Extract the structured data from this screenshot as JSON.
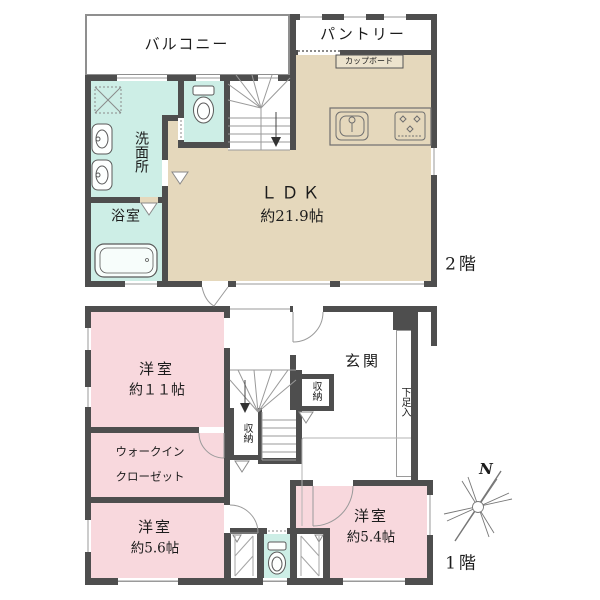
{
  "plan": {
    "floor2": {
      "label": "2階",
      "balcony": "バルコニー",
      "pantry": "パントリー",
      "cupboard": "カップボード",
      "washroom": "洗面所",
      "bath": "浴室",
      "ldk_name": "ＬＤＫ",
      "ldk_size": "約21.9帖"
    },
    "floor1": {
      "label": "1階",
      "bedroom1_name": "洋室",
      "bedroom1_size": "約１１帖",
      "wic_line1": "ウォークイン",
      "wic_line2": "クローゼット",
      "entrance": "玄関",
      "shoe_box": "下足入",
      "storage_a": "収納",
      "storage_b": "収納",
      "bedroom2_name": "洋室",
      "bedroom2_size": "約5.6帖",
      "bedroom3_name": "洋室",
      "bedroom3_size": "約5.4帖"
    },
    "compass": {
      "north": "N"
    },
    "colors": {
      "wall": "#4e4e4e",
      "ldk_floor": "#e5d8bc",
      "wet_area_floor": "#cdeee6",
      "bedroom_floor": "#f8d8dd"
    }
  }
}
